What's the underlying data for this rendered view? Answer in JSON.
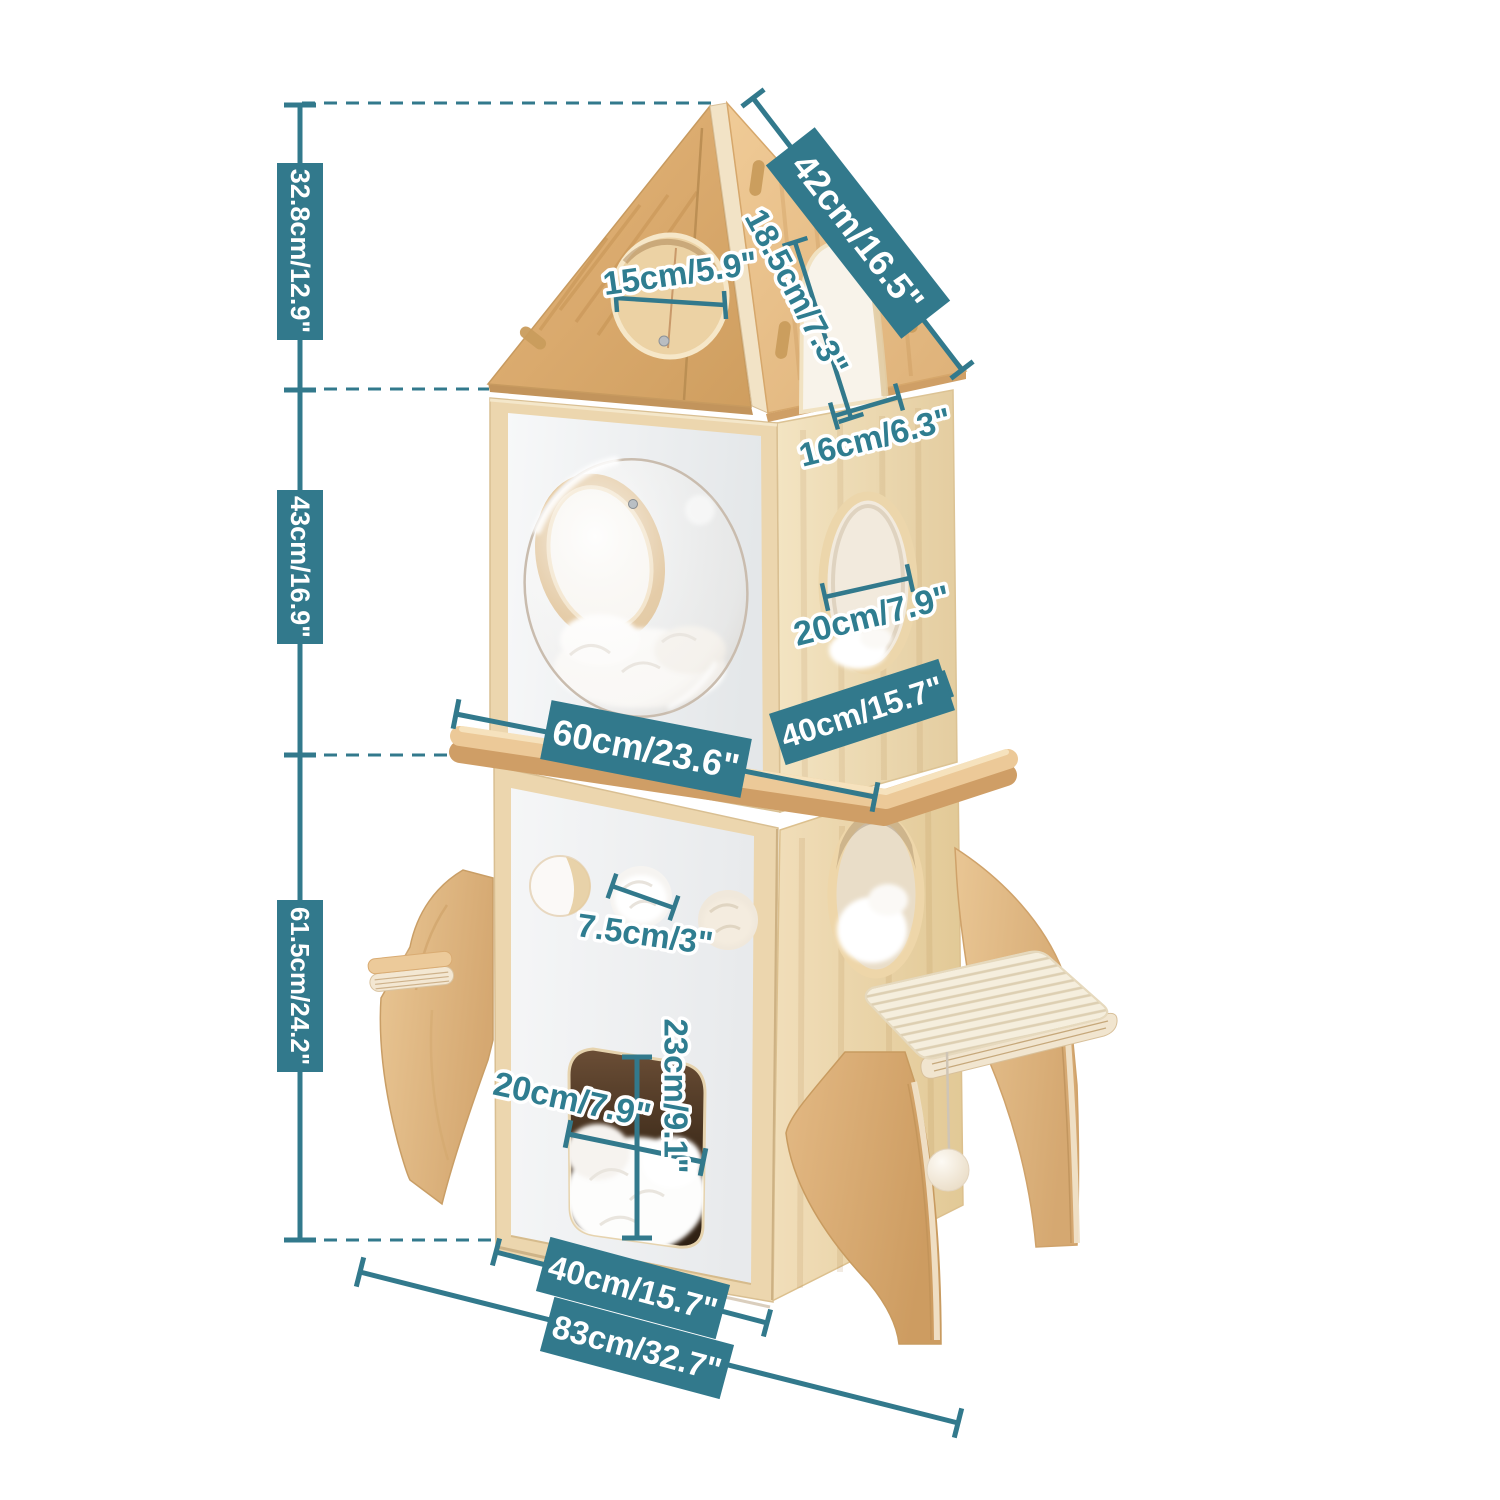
{
  "page": {
    "background": "#ffffff",
    "accent_color": "#32798c",
    "product_kind": "rocket-shaped cat tree dimension diagram"
  },
  "labels": {
    "height_top": "32.8cm/12.9\"",
    "height_mid": "43cm/16.9\"",
    "height_low": "61.5cm/24.2\"",
    "roof_slant": "42cm/16.5\"",
    "roof_hole_diameter": "15cm/5.9\"",
    "arch_height": "18.5cm/7.3\"",
    "arch_width": "16cm/6.3\"",
    "round_window_diameter": "20cm/7.9\"",
    "upper_depth": "40cm/15.7\"",
    "shelf_width": "60cm/23.6\"",
    "peep_hole_diameter": "7.5cm/3\"",
    "door_height": "23cm/9.1\"",
    "door_width": "20cm/7.9\"",
    "base_depth": "40cm/15.7\"",
    "base_width": "83cm/32.7\""
  },
  "colors": {
    "teal": "#32798c",
    "roof_wood": "#ddab72",
    "body_wood": "#ecd7b0",
    "panel_white": "#eef0f2",
    "fin_wood": "#ddb27e",
    "sisal": "#f4eddd"
  }
}
